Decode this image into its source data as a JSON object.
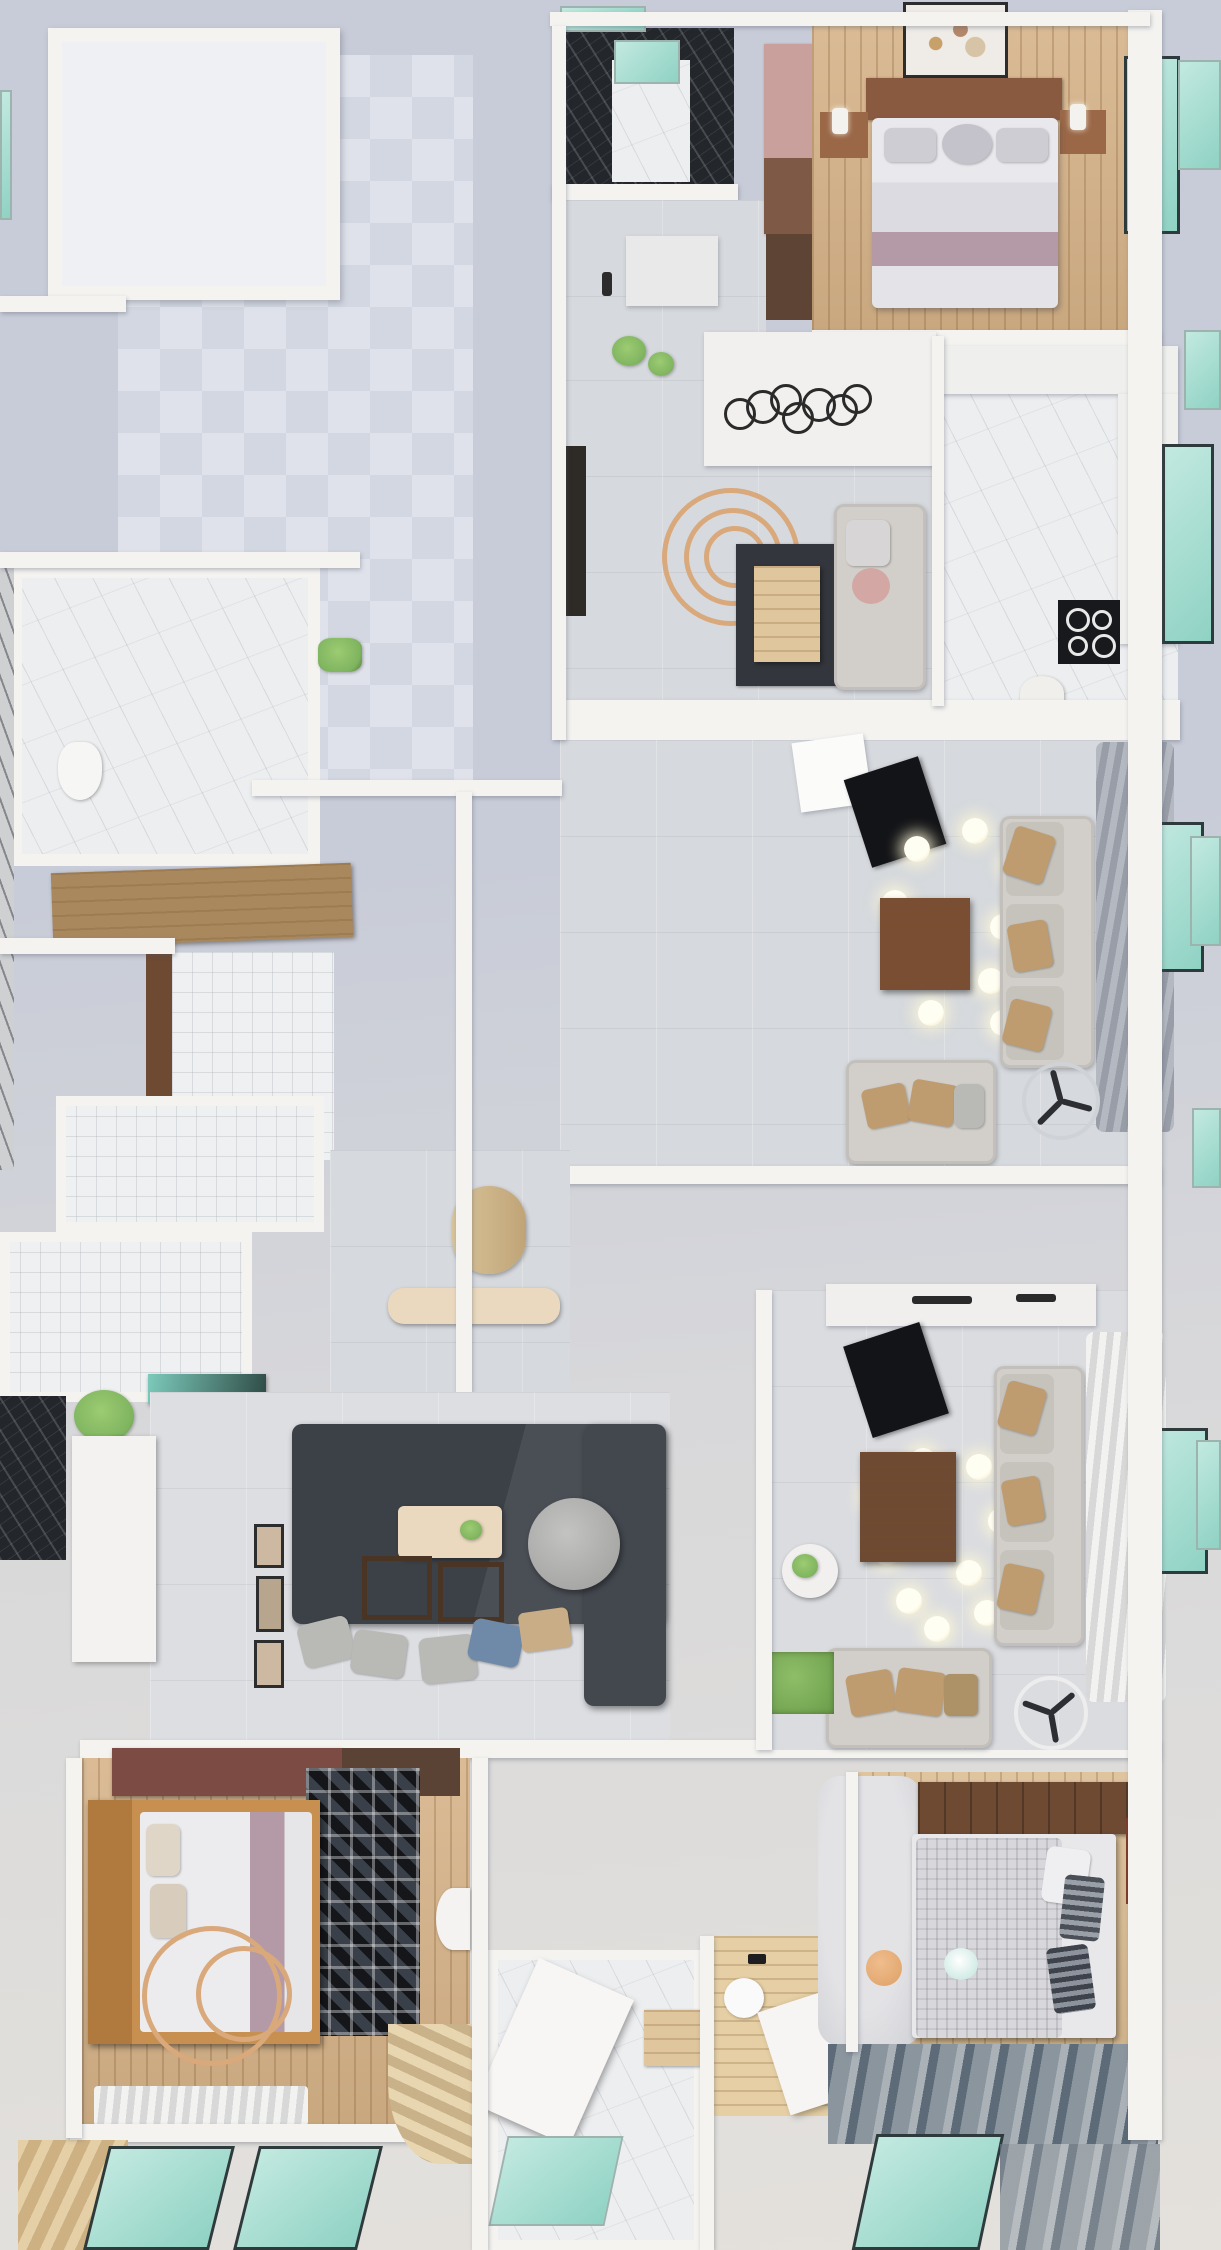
{
  "title": "top-view-3d-apartment-floor-plan-render",
  "palette": {
    "bg_top": "#c8ccd8",
    "bg_mid": "#d8d8da",
    "bg_bottom": "#e4e1dc",
    "wall": "#f4f3f0",
    "wall_shadow": "rgba(80,85,100,0.35)",
    "checker_a": "#dfe2ea",
    "checker_b": "#d2d7e1",
    "tile_gray": "#d6d9dd",
    "tile_white": "#eef0f1",
    "wood": "#d5b287",
    "wood_light": "#e0c69c",
    "wood_dark": "#8a5a40",
    "walnut": "#6e4a33",
    "maroon": "#7c4b44",
    "marble_white": "#eceef0",
    "marble_black": "#23262b",
    "teal": "#8fd2c4",
    "teal_light": "#c2e9e0",
    "charcoal": "#3c4148",
    "sofa": "#d2cfca",
    "pillow_tan": "#bf9c70",
    "mauve": "#b39AA6",
    "copper": "#d9a87b",
    "grass": "#7fb45f",
    "cream": "#ead9be",
    "black": "#17181b"
  },
  "scene": {
    "view": "orthographic top-down dollhouse render",
    "rooms": [
      {
        "name": "empty-room-top-left",
        "floor": "white",
        "contents": []
      },
      {
        "name": "terrace-checker",
        "floor": "checkered-tile",
        "contents": []
      },
      {
        "name": "bathroom-top",
        "floor": "white-marble",
        "contents": [
          "black-marble-walls",
          "teal-glass-shower",
          "green-skylight"
        ]
      },
      {
        "name": "bedroom-top-right",
        "floor": "oak-plank",
        "contents": [
          "double-bed-brown-headboard",
          "white-bedding",
          "mauve-runner",
          "two-nightstands",
          "wall-art-blossom",
          "wardrobe-brown",
          "teal-window"
        ]
      },
      {
        "name": "hallway-top",
        "floor": "gray-tile",
        "contents": [
          "white-door",
          "wardrobe-mauve-brown",
          "wall-sconce"
        ]
      },
      {
        "name": "kitchen",
        "floor": "white-marble",
        "contents": [
          "l-shaped-counter",
          "black-gas-hob",
          "teal-window",
          "bar-stool"
        ]
      },
      {
        "name": "dining-sitting",
        "floor": "gray-tile",
        "contents": [
          "black-ring-chandelier-ceiling",
          "copper-spiral-pendant",
          "dark-rug",
          "wood-dining-table",
          "gray-armchair-pink-pillow",
          "plants",
          "dark-console"
        ]
      },
      {
        "name": "living-room-a",
        "floor": "gray-tile",
        "contents": [
          "ac-unit",
          "black-tv-console",
          "globe-bulb-chandelier",
          "brown-coffee-table",
          "three-seat-sofa-tan-pillows",
          "gray-curtains",
          "teal-window",
          "loveseat",
          "ceiling-fan-dark"
        ]
      },
      {
        "name": "master-bathroom-left",
        "floor": "white-marble",
        "contents": [
          "wood-vanity-counter",
          "toilet",
          "green-towel",
          "white-tile-shower",
          "brown-door-frame"
        ]
      },
      {
        "name": "utility-rooms-left",
        "floor": "white-tile",
        "contents": [
          "teal-glass-counter",
          "potted-plants",
          "black-marble-corner"
        ]
      },
      {
        "name": "entry-foyer",
        "floor": "gray-tile",
        "contents": [
          "beige-bench",
          "oval-wall-art",
          "plant-shelf-dark-wood"
        ]
      },
      {
        "name": "family-lounge",
        "floor": "gray-tile",
        "contents": [
          "charcoal-l-sofa",
          "gray-pillows",
          "blue-pillow",
          "cream-tray-table",
          "round-gray-pouf",
          "wood-frame-side-tables",
          "gallery-frames",
          "white-cabinet"
        ]
      },
      {
        "name": "living-room-b",
        "floor": "gray-tile",
        "contents": [
          "kitchenette-counter",
          "black-tv-console",
          "globe-bulb-chandelier",
          "brown-coffee-table",
          "three-seat-sofa-tan-pillows",
          "white-curtains",
          "teal-window",
          "loveseat",
          "ceiling-fan-white",
          "side-table-plant",
          "grass-patch"
        ]
      },
      {
        "name": "bedroom-bottom-left",
        "floor": "oak-plank",
        "contents": [
          "maroon-wardrobe",
          "black-mosaic-rug",
          "oak-bed-frame",
          "white-bedding",
          "mauve-runner",
          "copper-ring-decor",
          "white-curtain",
          "round-side-table"
        ]
      },
      {
        "name": "stair-and-bath-bottom-center",
        "floor": "white-marble",
        "contents": [
          "fan-stairs",
          "open-white-door",
          "teal-skylight",
          "wood-stool"
        ]
      },
      {
        "name": "bathroom-bottom-right",
        "floor": "light-wood",
        "contents": [
          "wood-vanity",
          "round-basin",
          "tilted-white-desk"
        ]
      },
      {
        "name": "bedroom-bottom-right",
        "floor": "oak-plank",
        "contents": [
          "walnut-headboard",
          "patterned-gray-duvet",
          "striped-pillows",
          "light-gray-rug",
          "peach-pouf",
          "red-slim-cabinet"
        ]
      },
      {
        "name": "outdoor-bottom",
        "floor": "white-deck",
        "contents": [
          "two-teal-skylights",
          "wood-strip-deck",
          "louvered-blue-gray-deck",
          "teal-pool"
        ]
      }
    ],
    "exterior": [
      "teal-window-boxes-right-edge",
      "light-blue-gray-ground"
    ]
  }
}
